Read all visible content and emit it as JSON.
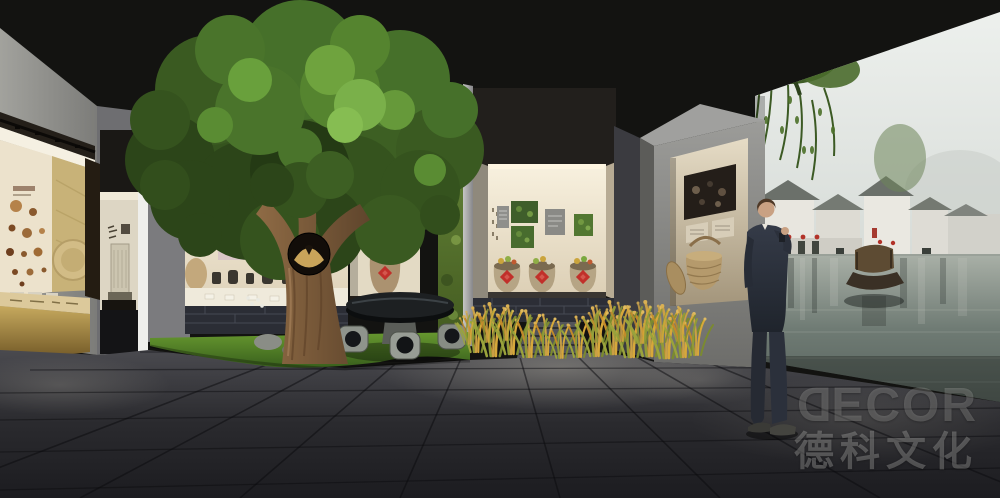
{
  "watermark": {
    "logo_first": "D",
    "logo_rest": "ECOR",
    "company": "德科文化"
  },
  "palette": {
    "ceiling": "#141412",
    "left_wall": "#96968f",
    "floor": "#28282c",
    "grass": "#4f7a2c",
    "rice_gold": "#c8922f",
    "tree_foliage": "#3d5f23",
    "trunk": "#7d5b3c",
    "case_light": "#f2e8d4",
    "plate_panel": "#d9c6c6",
    "seal_red": "#c0302a",
    "moss_wall": "#5d7c33",
    "brick_base": "#2e3038",
    "pillar": "#8e8e8b",
    "panel_beige": "#d9cfbc",
    "suit": "#2b303b",
    "mural_sky": "#e4e8e5",
    "mural_water": "#6f7b74",
    "roof_gray": "#70756f",
    "lantern_red": "#b23228",
    "gold_case": "#a98e4c"
  }
}
